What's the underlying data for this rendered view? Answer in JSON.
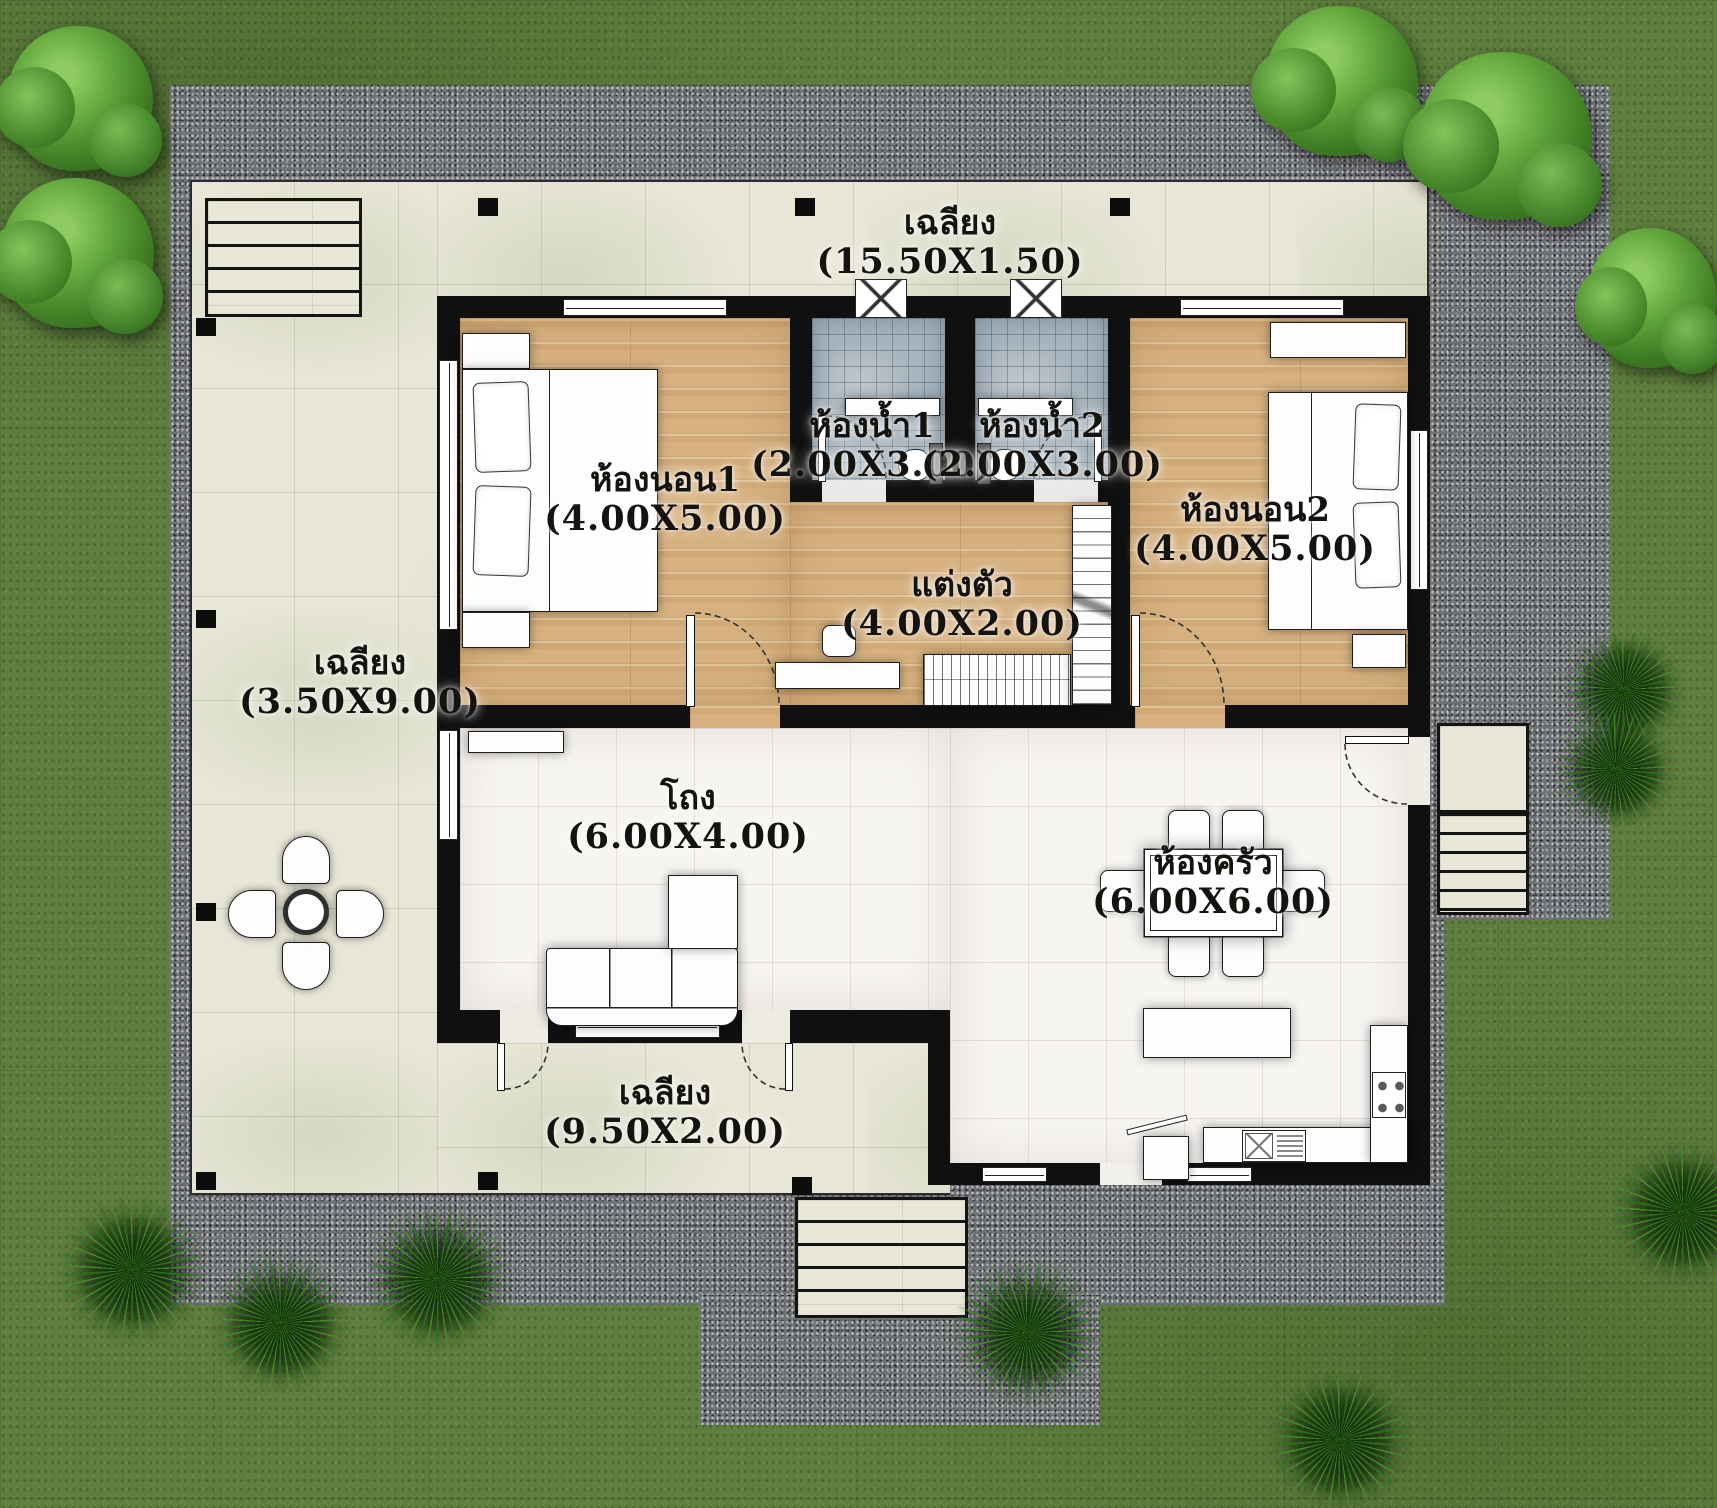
{
  "title": "House floor plan with 2 bedrooms",
  "rooms": [
    {
      "id": "porch-top",
      "name": "เฉลียง",
      "size": "(15.50X1.50)"
    },
    {
      "id": "bedroom-1",
      "name": "ห้องนอน1",
      "size": "(4.00X5.00)"
    },
    {
      "id": "bathroom-1",
      "name": "ห้องน้ำ1",
      "size": "(2.00X3.00)"
    },
    {
      "id": "bathroom-2",
      "name": "ห้องน้ำ2",
      "size": "(2.00X3.00)"
    },
    {
      "id": "bedroom-2",
      "name": "ห้องนอน2",
      "size": "(4.00X5.00)"
    },
    {
      "id": "dressing",
      "name": "แต่งตัว",
      "size": "(4.00X2.00)"
    },
    {
      "id": "porch-left",
      "name": "เฉลียง",
      "size": "(3.50X9.00)"
    },
    {
      "id": "hall",
      "name": "โถง",
      "size": "(6.00X4.00)"
    },
    {
      "id": "kitchen",
      "name": "ห้องครัว",
      "size": "(6.00X6.00)"
    },
    {
      "id": "porch-bottom",
      "name": "เฉลียง",
      "size": "(9.50X2.00)"
    }
  ],
  "colors": {
    "grass": "#5f7f3e",
    "gravel": "#6f7275",
    "terrace_tile": "#e8e6d6",
    "wood_floor": "#d6b17f",
    "bath_tile": "#a8b4bd",
    "interior_floor": "#f7f5f2",
    "wall": "#101010",
    "label_text": "#15130f"
  }
}
